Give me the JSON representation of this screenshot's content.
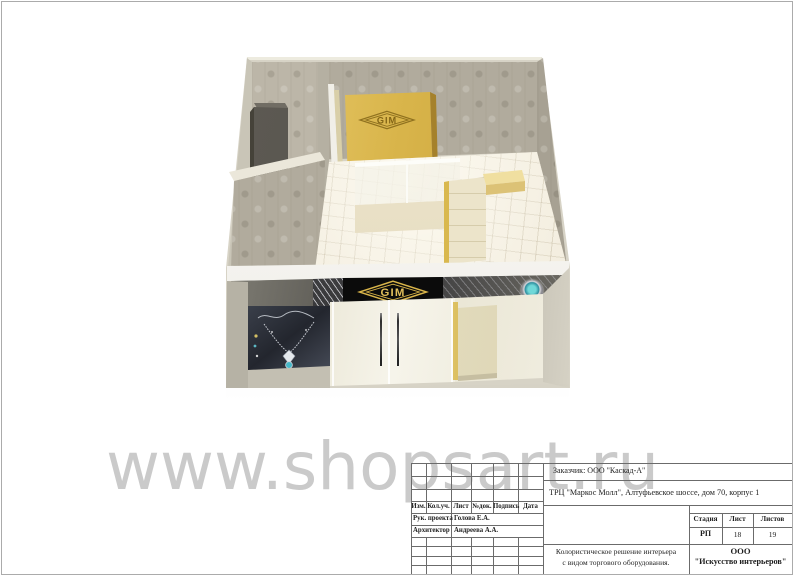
{
  "watermark": {
    "text": "www.shopsart.ru"
  },
  "brand": {
    "name": "GIM"
  },
  "colors": {
    "brand_gold": "#d4af37",
    "fascia_black": "#0d0d0d",
    "wallpaper": "#b1ab9d",
    "floor": "#f2ecdd",
    "gold_panel": "#d8b64e"
  },
  "title_block": {
    "customer": "Заказчик: ООО \"Каскад-А\"",
    "project": "ТРЦ \"Маркос Молл\", Алтуфьевское шоссе, дом 70, корпус 1",
    "cols": {
      "izm": "Изм.",
      "kol": "Кол.уч.",
      "list": "Лист",
      "doc": "№док.",
      "sign": "Подпись",
      "date": "Дата"
    },
    "roles": [
      {
        "role": "Рук. проекта",
        "name": "Голова Е.А."
      },
      {
        "role": "Архитектор",
        "name": "Андреева А.А."
      }
    ],
    "stage": {
      "h_stage": "Стадия",
      "h_sheet": "Лист",
      "h_sheets": "Листов",
      "stage": "РП",
      "sheet": "18",
      "sheets": "19"
    },
    "description": {
      "line1": "Колористическое решение интерьера",
      "line2": "с видом торгового оборудования."
    },
    "company": {
      "line1": "ООО",
      "line2": "\"Искусство интерьеров\""
    }
  }
}
